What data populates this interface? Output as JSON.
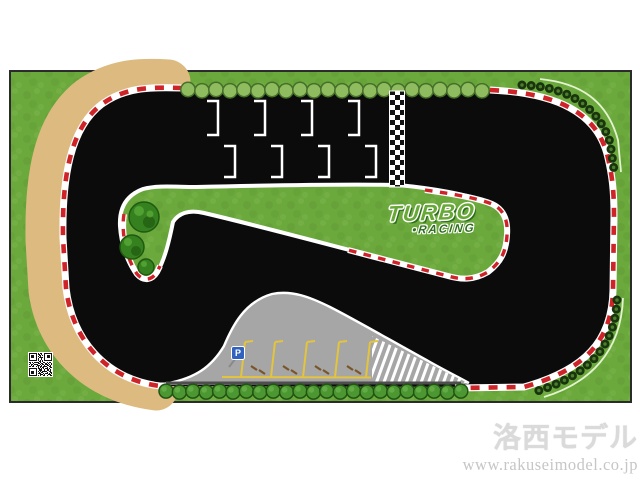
{
  "page": {
    "background": "#ffffff"
  },
  "mat": {
    "description": "Turbo Racing mini RC drift race track mat",
    "logo": {
      "line1": "TURBO",
      "line2": "•RACING"
    },
    "parking": {
      "sign_label": "P",
      "slot_count": 5
    },
    "start_grid": {
      "grid_box_count": 8,
      "finish_line_style": "checkered"
    },
    "colors": {
      "mat_border": "#2b2b2b",
      "grass": "#6CA93D",
      "grass_dark": "#609B35",
      "grass_light": "#78B449",
      "track": "#0B0B0B",
      "sand": "#DDBB80",
      "curb_red": "#CE2429",
      "curb_white": "#FFFFFF",
      "tire_dark": "#18350D",
      "tire_light": "#4E7D2E",
      "arc_light": "#E4F3CF",
      "hedge_top_fill": "#8FBC5E",
      "hedge_top_stroke": "#46702A",
      "hedge_bot_fill": "#4D9733",
      "hedge_bot_stroke": "#215413",
      "hedge_bot_hi": "#66AF49",
      "tree_dark": "#1E5A10",
      "tree_mid": "#36811F",
      "tree_light": "#57A737",
      "parking_gray": "#A6A6A6",
      "parking_line_dark": "#4E4E4E",
      "yellow": "#E4C43C",
      "brown": "#7A5526",
      "sign_blue": "#3061BE",
      "logo_green": "#68A836",
      "logo_dark_green": "#2E6E1C",
      "watermark_gray": "#DADADA",
      "url_gray": "#C6C6C6"
    }
  },
  "watermark": {
    "title": "洛西モデル",
    "url": "www.rakuseimodel.co.jp"
  },
  "qr": {
    "rows": [
      "111111101011001111111",
      "100000101101001000001",
      "101110100110101011101",
      "101110101010001011101",
      "101110100111101011101",
      "100000101001001000001",
      "111111101010101111111",
      "000000000110100000000",
      "110101111010011010110",
      "010010001101100101001",
      "101101110010110110101",
      "001010011101001011010",
      "110110101011011100110",
      "000000001010110010011",
      "111111101101010110100",
      "100000100111001011010",
      "101110101010111100110",
      "101110100101100010011",
      "101110101110010110101",
      "100000100011101001110",
      "111111101010011010011"
    ]
  }
}
